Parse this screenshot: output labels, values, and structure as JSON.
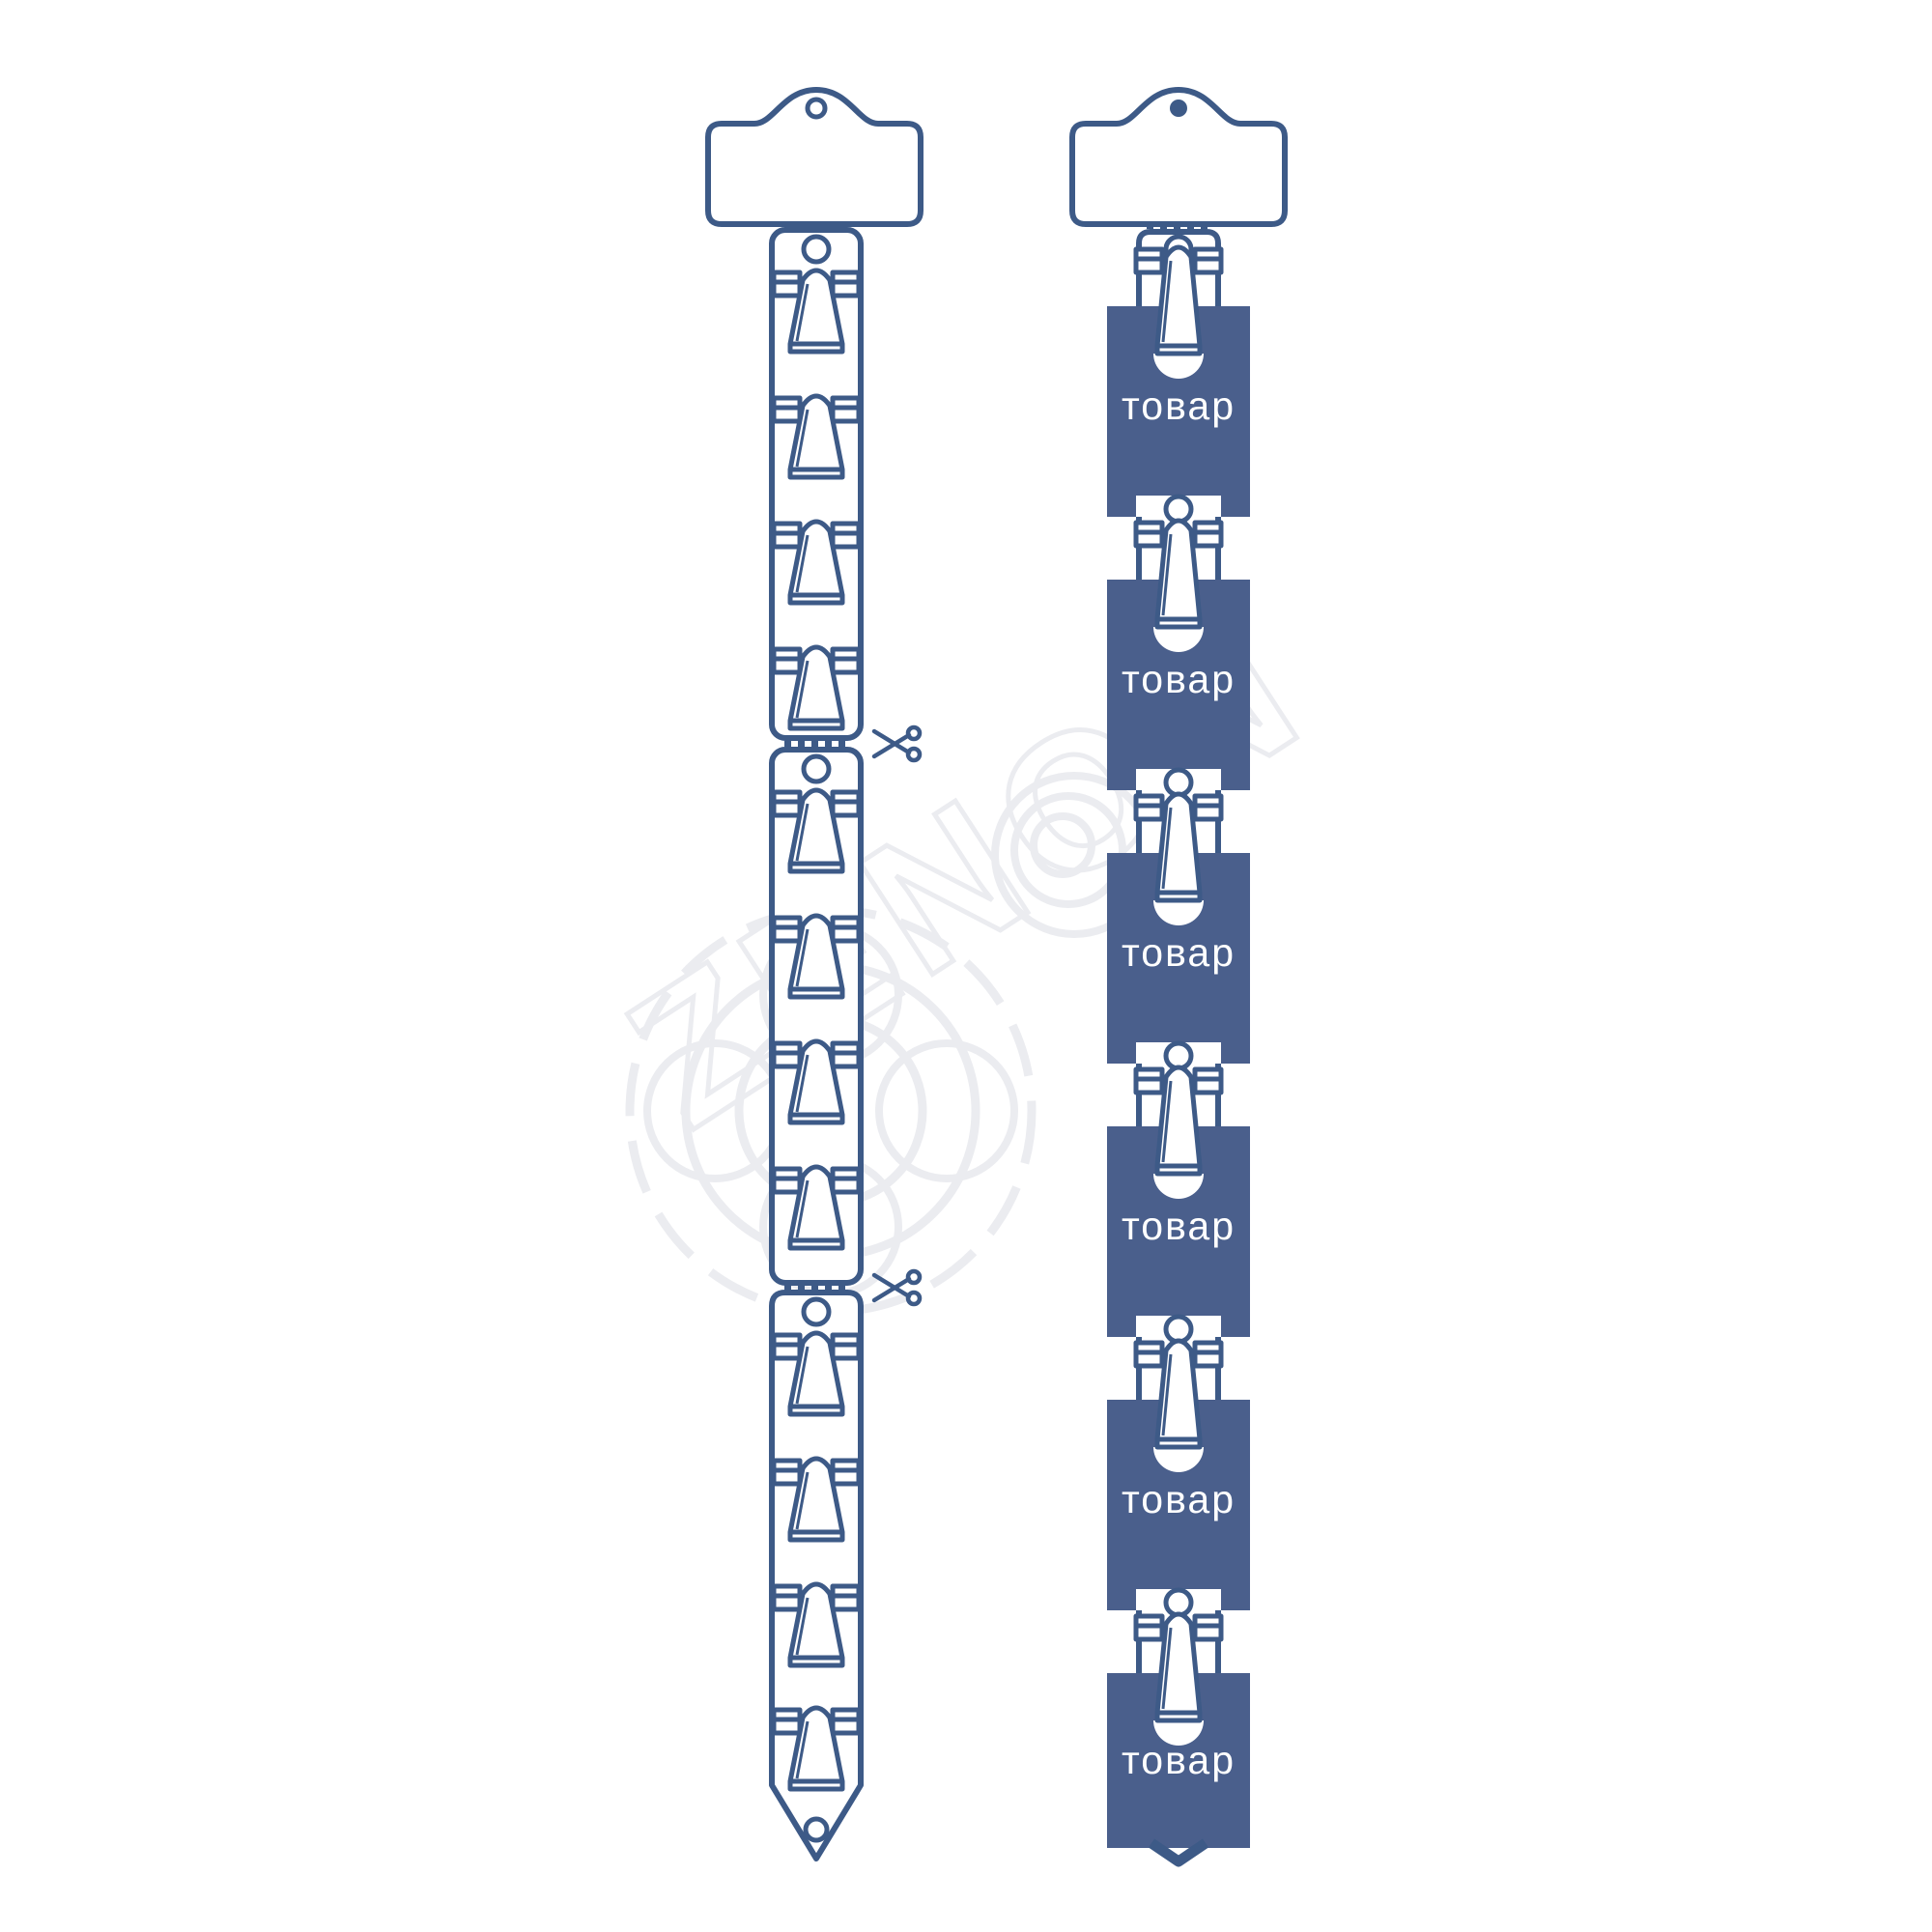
{
  "colors": {
    "outline": "#3d5a87",
    "product_fill": "#4a5f8c",
    "product_text": "#ffffff",
    "watermark": "#ebecf0",
    "background": "#ffffff"
  },
  "watermark": {
    "text": "ZENON"
  },
  "left_strip": {
    "header_card": {
      "text": ""
    },
    "hang_hole": "open",
    "segments": [
      {
        "clips": 4,
        "hang_hole": true
      },
      {
        "clips": 4,
        "hang_hole": true
      },
      {
        "clips": 4,
        "hang_hole": true,
        "bottom_hole": true,
        "pointed_tip": true
      }
    ],
    "perforation_count": 3,
    "scissors_count": 2
  },
  "right_strip": {
    "header_card": {
      "text": ""
    },
    "hang_hole": "filled",
    "clip_count": 6,
    "pointed_tip": true,
    "products": [
      {
        "label": "товар"
      },
      {
        "label": "товар"
      },
      {
        "label": "товар"
      },
      {
        "label": "товар"
      },
      {
        "label": "товар"
      },
      {
        "label": "товар"
      }
    ]
  }
}
